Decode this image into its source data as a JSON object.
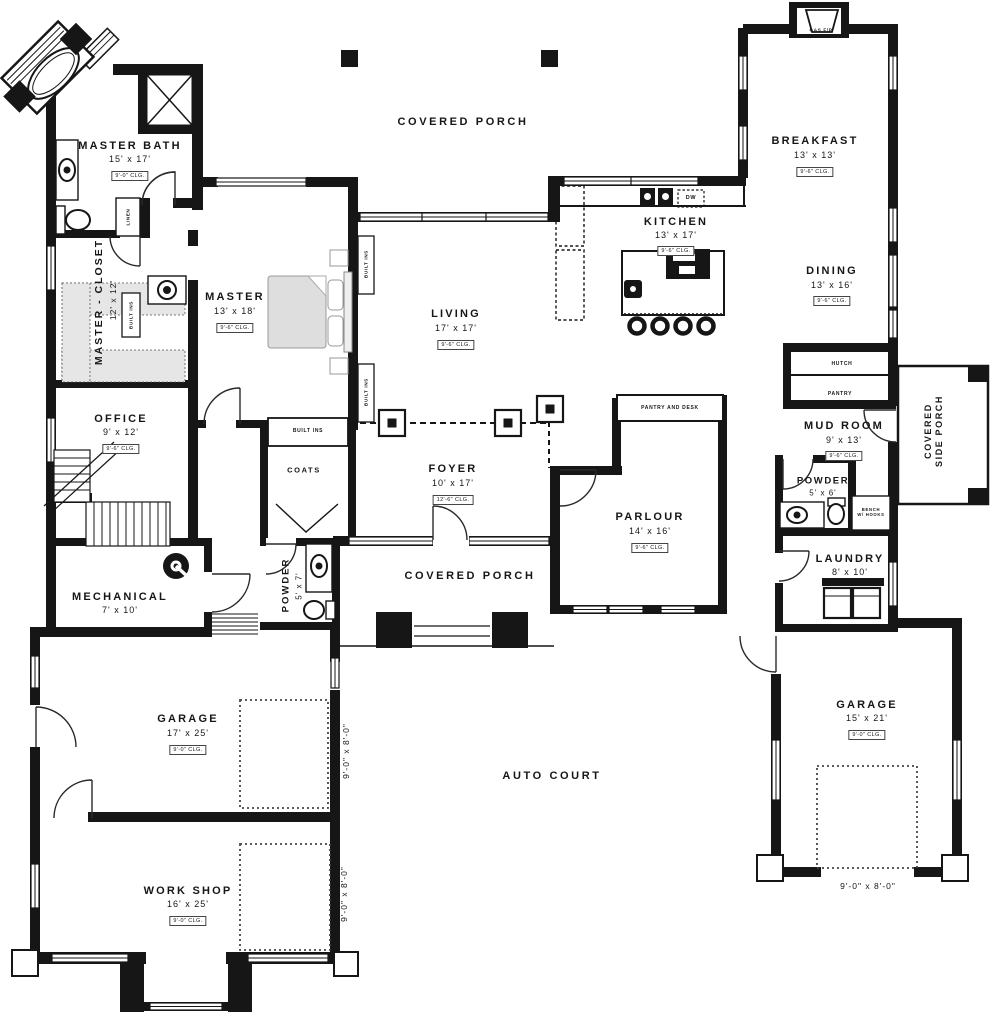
{
  "plan": {
    "rooms": [
      {
        "name": "MASTER BATH",
        "dims": "15' x 17'",
        "clg": "9'-0\" CLG."
      },
      {
        "name": "MASTER - CLOSET",
        "dims": "12' x 12'"
      },
      {
        "name": "MASTER",
        "dims": "13' x 18'",
        "clg": "9'-6\" CLG."
      },
      {
        "name": "OFFICE",
        "dims": "9' x 12'",
        "clg": "9'-6\" CLG."
      },
      {
        "name": "LIVING",
        "dims": "17' x 17'",
        "clg": "9'-6\" CLG."
      },
      {
        "name": "FOYER",
        "dims": "10' x 17'",
        "clg": "12'-6\" CLG."
      },
      {
        "name": "KITCHEN",
        "dims": "13' x 17'",
        "clg": "9'-6\" CLG."
      },
      {
        "name": "BREAKFAST",
        "dims": "13' x 13'",
        "clg": "9'-6\" CLG."
      },
      {
        "name": "DINING",
        "dims": "13' x 16'",
        "clg": "9'-6\" CLG."
      },
      {
        "name": "MUD ROOM",
        "dims": "9' x 13'",
        "clg": "9'-6\" CLG."
      },
      {
        "name": "POWDER",
        "dims": "5' x 6'"
      },
      {
        "name": "LAUNDRY",
        "dims": "8' x 10'"
      },
      {
        "name": "PARLOUR",
        "dims": "14' x 16'",
        "clg": "9'-6\" CLG."
      },
      {
        "name": "MECHANICAL",
        "dims": "7' x 10'"
      },
      {
        "name": "POWDER",
        "dims": "5' x 7'"
      },
      {
        "name": "GARAGE",
        "dims": "17' x 25'",
        "clg": "9'-0\" CLG."
      },
      {
        "name": "WORK SHOP",
        "dims": "16' x 25'",
        "clg": "9'-0\" CLG."
      },
      {
        "name": "GARAGE",
        "dims": "15' x 21'",
        "clg": "9'-0\" CLG."
      }
    ],
    "areas": {
      "porch_top": "COVERED PORCH",
      "porch_mid": "COVERED PORCH",
      "side_porch_line1": "COVERED",
      "side_porch_line2": "SIDE PORCH",
      "auto_court": "AUTO COURT"
    },
    "features": {
      "coats": "COATS",
      "built_ins": "BUILT INS",
      "hutch": "HUTCH",
      "pantry": "PANTRY",
      "pantry_desk": "PANTRY AND DESK",
      "bench_line1": "BENCH",
      "bench_line2": "W/ HOOKS",
      "gas_fp": "GAS F/P",
      "dw": "DW",
      "linen": "LINEN"
    },
    "garage_doors": {
      "left": "9'-0\" x 8'-0\"",
      "workshop": "9'-0\" x 8'-0\"",
      "right": "9'-0\" x 8'-0\""
    },
    "colors": {
      "ink": "#161616",
      "paper": "#ffffff",
      "shelf_gray": "#e6e6e6"
    }
  }
}
